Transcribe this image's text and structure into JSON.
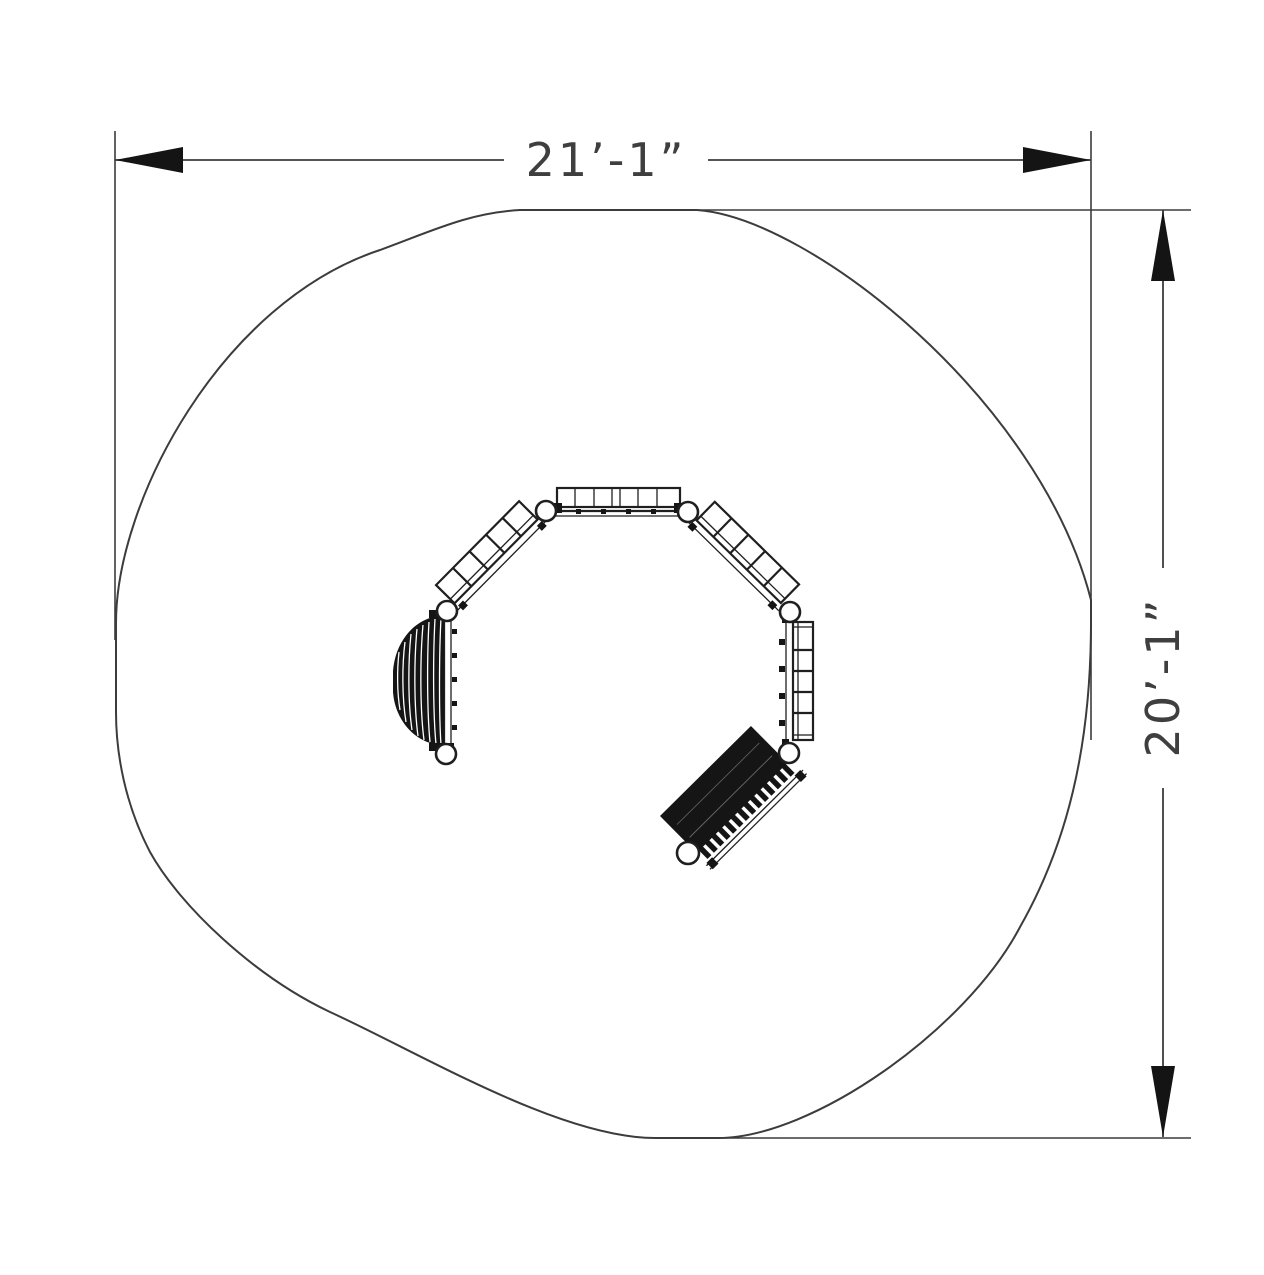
{
  "page": {
    "background_color": "#ffffff",
    "kind": "playground-equipment-plan-view-drawing"
  },
  "dimensions": {
    "horizontal": {
      "label": "21’-1”"
    },
    "vertical": {
      "label": "20’-1”"
    }
  },
  "colors": {
    "line": "#3c3c3c",
    "equipment_line": "#1f1f1f",
    "equipment_fill": "#151515",
    "arrow_fill": "#141414",
    "background": "#ffffff"
  },
  "components": {
    "surface": "protective-surfacing-outline",
    "post_count": 7,
    "items": [
      "panel-bridge",
      "inclined-ladder-left",
      "inclined-ladder-right",
      "vertical-ladder-right",
      "dome-climber",
      "climbing-ramp"
    ]
  }
}
